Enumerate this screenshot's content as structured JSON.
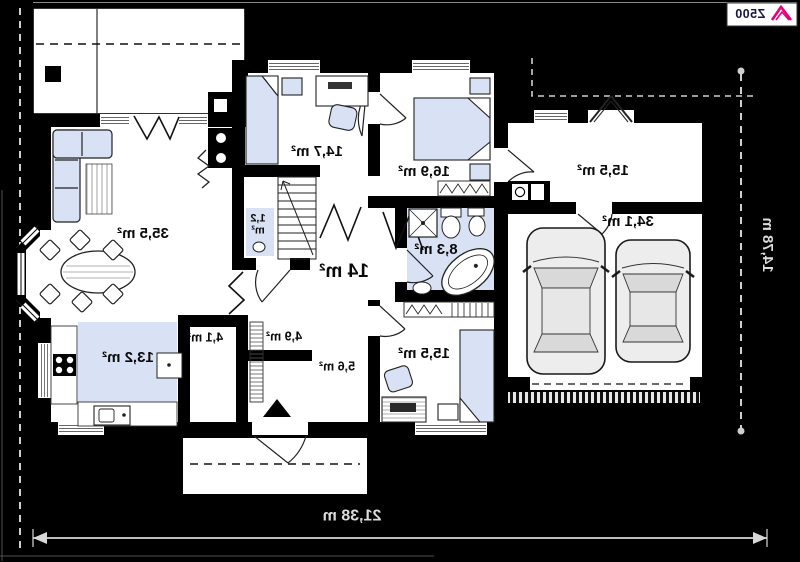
{
  "logo": {
    "text": "Z500"
  },
  "dimensions": {
    "width": "21,38 m",
    "height": "14,78 m"
  },
  "rooms": [
    {
      "id": "living-room",
      "area": "35,5 m²"
    },
    {
      "id": "bedroom-top",
      "area": "14,7 m²"
    },
    {
      "id": "wc",
      "area": "1,2 m²"
    },
    {
      "id": "hallway",
      "area": "14 m²"
    },
    {
      "id": "bedroom-right",
      "area": "16,9 m²"
    },
    {
      "id": "bathroom",
      "area": "8,3 m²"
    },
    {
      "id": "utility-room",
      "area": "15,5 m²"
    },
    {
      "id": "garage",
      "area": "34,1 m²"
    },
    {
      "id": "kitchen",
      "area": "13,2 m²"
    },
    {
      "id": "pantry",
      "area": "4,1 m²"
    },
    {
      "id": "hall",
      "area": "4,9 m²"
    },
    {
      "id": "vestibule",
      "area": "5,6 m²"
    },
    {
      "id": "bedroom-bottom",
      "area": "15,5 m²"
    }
  ],
  "colors": {
    "background": "#000000",
    "walls": "#000000",
    "floor": "#ffffff",
    "furniture": "#d9e2f4",
    "accent_logo": "#e5007d",
    "dimension_text": "#dcdcdc",
    "car_body": "#ededed"
  }
}
